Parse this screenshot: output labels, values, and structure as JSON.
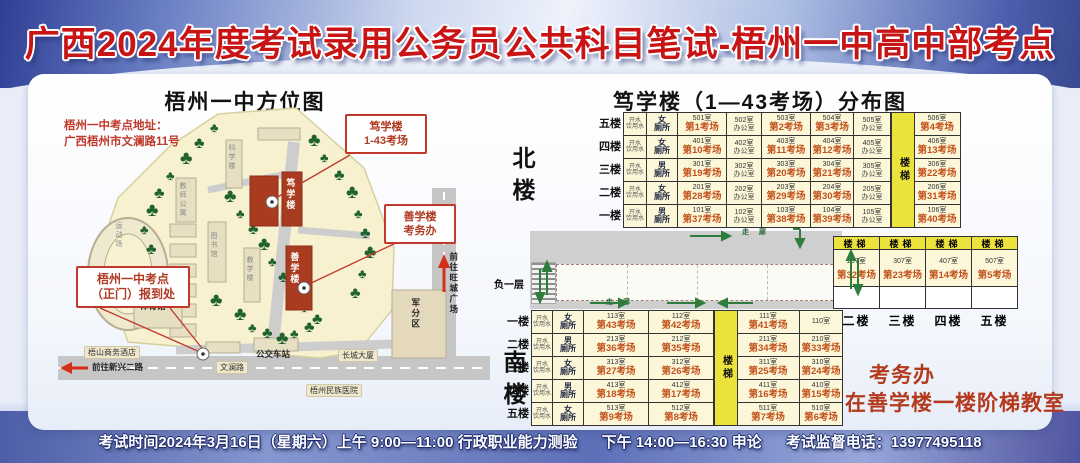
{
  "colors": {
    "title_red": "#c81414",
    "exam_text": "#c2511c",
    "stairs_yellow": "#ece23c",
    "building_red": "#a93b20",
    "table_bg": "#fbf7d8",
    "note_red": "#b43a1e"
  },
  "title": "广西2024年度考试录用公务员公共科目笔试-梧州一中高中部考点",
  "map": {
    "title": "梧州一中方位图",
    "address_line1": "梧州一中考点地址：",
    "address_line2": "广西梧州市文澜路11号",
    "callouts": [
      {
        "id": "duxue",
        "lines": [
          "笃学楼",
          "1-43考场"
        ]
      },
      {
        "id": "shanxue",
        "lines": [
          "善学楼",
          "考务办"
        ]
      },
      {
        "id": "gate",
        "lines": [
          "梧州一中考点",
          "（正门）报到处"
        ]
      }
    ],
    "labels": [
      {
        "t": "运动场",
        "x": 56,
        "y": 116,
        "v": 1,
        "c": "bld"
      },
      {
        "t": "体育馆",
        "x": 82,
        "y": 196,
        "c": "dark"
      },
      {
        "t": "科学楼",
        "x": 169,
        "y": 38,
        "v": 1,
        "c": "bld"
      },
      {
        "t": "图书馆",
        "x": 151,
        "y": 126,
        "v": 1,
        "c": "bld"
      },
      {
        "t": "教学楼",
        "x": 187,
        "y": 150,
        "v": 1,
        "c": "bld"
      },
      {
        "t": "教师公寓",
        "x": 120,
        "y": 76,
        "v": 1,
        "c": "bld"
      },
      {
        "t": "笃学楼",
        "x": 227,
        "y": 72,
        "v": 1,
        "c": "onred"
      },
      {
        "t": "善学楼",
        "x": 231,
        "y": 146,
        "v": 1,
        "c": "onred"
      },
      {
        "t": "公交车站",
        "x": 198,
        "y": 244,
        "c": "dark"
      },
      {
        "t": "长城大厦",
        "x": 280,
        "y": 243,
        "c": "chip"
      },
      {
        "t": "军分区",
        "x": 352,
        "y": 192,
        "v": 1,
        "c": "dark"
      },
      {
        "t": "梧州民族医院",
        "x": 248,
        "y": 278,
        "c": "chip"
      },
      {
        "t": "梧山商务酒店",
        "x": 26,
        "y": 240,
        "c": "chip"
      },
      {
        "t": "文澜路",
        "x": 158,
        "y": 255,
        "c": "chip"
      },
      {
        "t": "前往新兴二路",
        "x": 34,
        "y": 257,
        "c": "roadlab"
      },
      {
        "t": "前往旺城广场",
        "x": 390,
        "y": 146,
        "v": 1,
        "c": "dark"
      }
    ]
  },
  "floorplan": {
    "title": "笃学楼（1—43考场）分布图",
    "stairs_label": "楼梯",
    "water_label": "开水\n饮用水",
    "basement_label": "负一层",
    "corridor_label": "走 廊",
    "north": {
      "label": "北楼",
      "floors": [
        {
          "floor": "五楼",
          "toilet": "女厕所",
          "rooms": [
            [
              "501室",
              "第1考场"
            ],
            [
              "502室",
              "办公室"
            ],
            [
              "503室",
              "第2考场"
            ],
            [
              "504室",
              "第3考场"
            ],
            [
              "505室",
              "办公室"
            ],
            [
              "506室",
              "第4考场"
            ]
          ]
        },
        {
          "floor": "四楼",
          "toilet": "女厕所",
          "rooms": [
            [
              "401室",
              "第10考场"
            ],
            [
              "402室",
              "办公室"
            ],
            [
              "403室",
              "第11考场"
            ],
            [
              "404室",
              "第12考场"
            ],
            [
              "405室",
              "办公室"
            ],
            [
              "406室",
              "第13考场"
            ]
          ]
        },
        {
          "floor": "三楼",
          "toilet": "男厕所",
          "rooms": [
            [
              "301室",
              "第19考场"
            ],
            [
              "302室",
              "办公室"
            ],
            [
              "303室",
              "第20考场"
            ],
            [
              "304室",
              "第21考场"
            ],
            [
              "305室",
              "办公室"
            ],
            [
              "306室",
              "第22考场"
            ]
          ]
        },
        {
          "floor": "二楼",
          "toilet": "女厕所",
          "rooms": [
            [
              "201室",
              "第28考场"
            ],
            [
              "202室",
              "办公室"
            ],
            [
              "203室",
              "第29考场"
            ],
            [
              "204室",
              "第30考场"
            ],
            [
              "205室",
              "办公室"
            ],
            [
              "206室",
              "第31考场"
            ]
          ]
        },
        {
          "floor": "一楼",
          "toilet": "男厕所",
          "rooms": [
            [
              "101室",
              "第37考场"
            ],
            [
              "102室",
              "办公室"
            ],
            [
              "103室",
              "第38考场"
            ],
            [
              "104室",
              "第39考场"
            ],
            [
              "105室",
              "办公室"
            ],
            [
              "106室",
              "第40考场"
            ]
          ]
        }
      ]
    },
    "south": {
      "label": "南楼",
      "floors": [
        {
          "floor": "一楼",
          "toilet": "女厕所",
          "rooms": [
            [
              "113室",
              "第43考场"
            ],
            [
              "112室",
              "第42考场"
            ],
            [
              "111室",
              "第41考场"
            ],
            [
              "110室",
              ""
            ]
          ]
        },
        {
          "floor": "二楼",
          "toilet": "男厕所",
          "rooms": [
            [
              "213室",
              "第36考场"
            ],
            [
              "212室",
              "第35考场"
            ],
            [
              "211室",
              "第34考场"
            ],
            [
              "210室",
              "第33考场"
            ]
          ]
        },
        {
          "floor": "三楼",
          "toilet": "女厕所",
          "rooms": [
            [
              "313室",
              "第27考场"
            ],
            [
              "312室",
              "第26考场"
            ],
            [
              "311室",
              "第25考场"
            ],
            [
              "310室",
              "第24考场"
            ]
          ]
        },
        {
          "floor": "四楼",
          "toilet": "男厕所",
          "rooms": [
            [
              "413室",
              "第18考场"
            ],
            [
              "412室",
              "第17考场"
            ],
            [
              "411室",
              "第16考场"
            ],
            [
              "410室",
              "第15考场"
            ]
          ]
        },
        {
          "floor": "五楼",
          "toilet": "女厕所",
          "rooms": [
            [
              "513室",
              "第9考场"
            ],
            [
              "512室",
              "第8考场"
            ],
            [
              "511室",
              "第7考场"
            ],
            [
              "510室",
              "第6考场"
            ]
          ]
        }
      ]
    },
    "annex": {
      "cols": [
        {
          "stairs": "楼梯",
          "no": "207室",
          "name": "第32考场",
          "floor": "二楼"
        },
        {
          "stairs": "楼梯",
          "no": "307室",
          "name": "第23考场",
          "floor": "三楼"
        },
        {
          "stairs": "楼梯",
          "no": "407室",
          "name": "第14考场",
          "floor": "四楼"
        },
        {
          "stairs": "楼梯",
          "no": "507室",
          "name": "第5考场",
          "floor": "五楼"
        }
      ]
    }
  },
  "office_note": {
    "line1": "考务办",
    "line2": "在善学楼一楼阶梯教室"
  },
  "footer": {
    "time": "考试时间2024年3月16日（星期六）上午 9:00—11:00 行政职业能力测验",
    "afternoon": "下午 14:00—16:30 申论",
    "phone": "考试监督电话：13977495118"
  }
}
